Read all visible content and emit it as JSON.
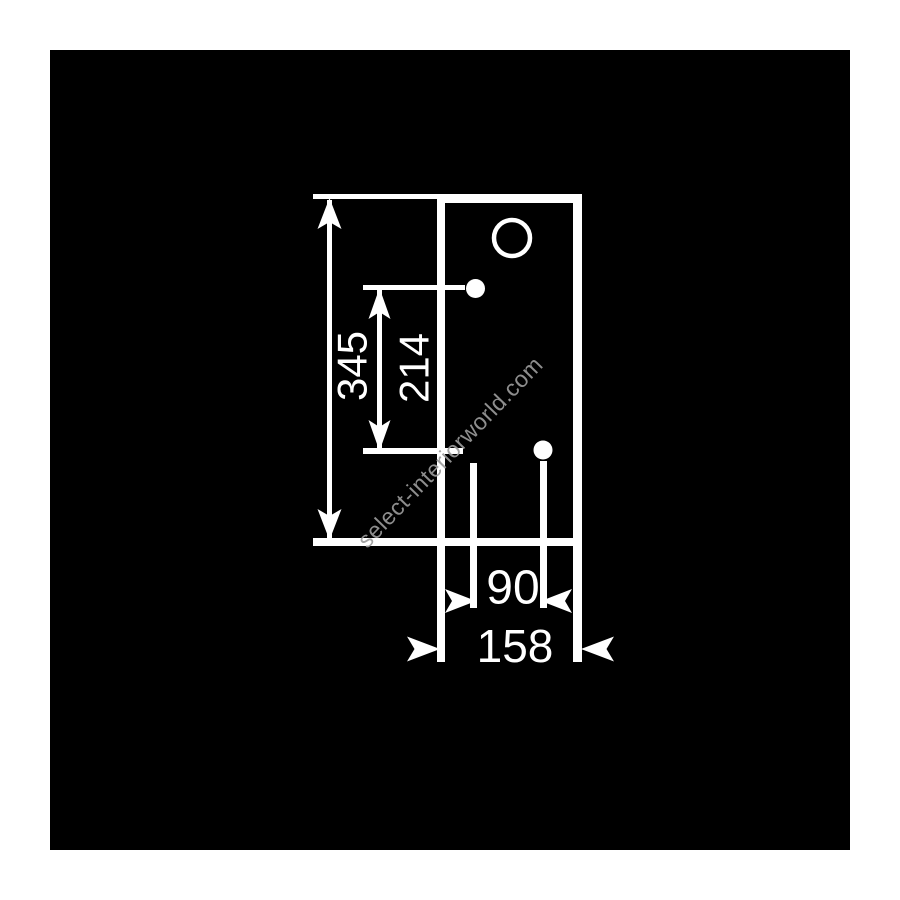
{
  "drawing": {
    "type": "technical-dimension-diagram",
    "colors": {
      "page_background": "#ffffff",
      "canvas_background": "#000000",
      "line": "#ffffff",
      "watermark_text": "#9b9b9b"
    },
    "dimensions": {
      "total_height": "345",
      "upper_section_height": "214",
      "hole_spacing_width": "90",
      "total_width": "158"
    },
    "watermark": {
      "text": "select-interiorworld.com"
    }
  }
}
